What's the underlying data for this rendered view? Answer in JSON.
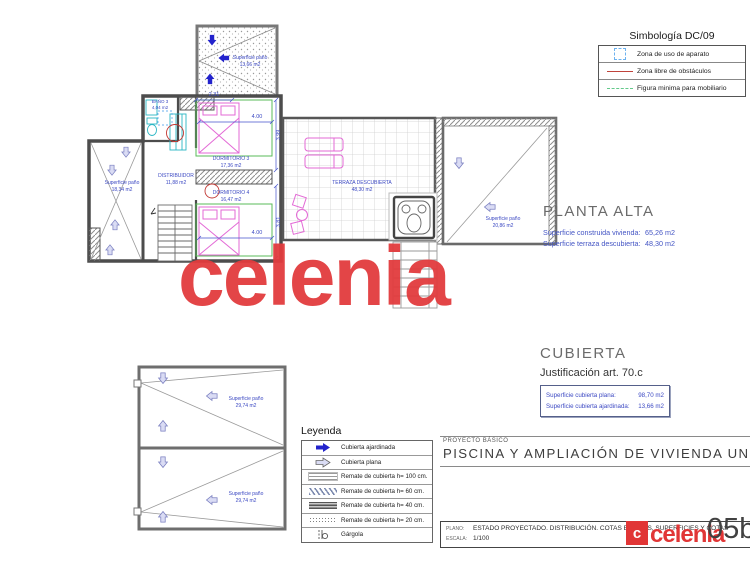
{
  "watermark": "celenia",
  "simbologia": {
    "title": "Simbología DC/09",
    "items": [
      {
        "icon": "zone-square-icon",
        "label": "Zona de uso de aparato"
      },
      {
        "icon": "red-line-icon",
        "label": "Zona libre de obstáculos"
      },
      {
        "icon": "green-line-icon",
        "label": "Figura minima para mobiliario"
      }
    ]
  },
  "planta_alta": {
    "title": "PLANTA ALTA",
    "rows": [
      {
        "label": "Superficie construida vivienda:",
        "value": "65,26 m2"
      },
      {
        "label": "Superficie terraza descubierta:",
        "value": "48,30 m2"
      }
    ]
  },
  "cubierta": {
    "title": "CUBIERTA",
    "subtitle": "Justificación art. 70.c",
    "rows": [
      {
        "label": "Superficie cubierta plana:",
        "value": "98,70 m2"
      },
      {
        "label": "Superficie cubierta ajardinada:",
        "value": "13,66 m2"
      }
    ]
  },
  "leyenda": {
    "title": "Leyenda",
    "items": [
      {
        "icon": "arrow-solid",
        "label": "Cubierta ajardinada"
      },
      {
        "icon": "arrow-outline",
        "label": "Cubierta plana"
      },
      {
        "icon": "hatch-100",
        "label": "Remate de cubierta h= 100 cm."
      },
      {
        "icon": "hatch-60",
        "label": "Remate de cubierta h= 60 cm."
      },
      {
        "icon": "hatch-40",
        "label": "Remate de cubierta h= 40 cm."
      },
      {
        "icon": "hatch-20",
        "label": "Remate de cubierta h= 20 cm."
      },
      {
        "icon": "gargoyle",
        "label": "Gárgola"
      }
    ]
  },
  "title_block": {
    "project_type": "PROYECTO BÁSICO",
    "project_title": "PISCINA Y AMPLIACIÓN  DE VIVIENDA UNIFAMILIAR",
    "plano_label": "PLANO:",
    "plano_value": "ESTADO PROYECTADO. DISTRIBUCIÓN. COTAS BÁSICAS, SUPERFICIES Y COTAS",
    "escala_label": "ESCALA:",
    "escala_value": "1/100",
    "logo_mark": "c",
    "logo_text": "celenia",
    "sheet_number": "05b"
  },
  "plan": {
    "patio_top": {
      "label": "Superficie paño",
      "area": "13,66 m2"
    },
    "patio_left": {
      "label": "Superficie paño",
      "area": "18,34 m2"
    },
    "patio_right": {
      "label": "Superficie paño",
      "area": "20,86 m2"
    },
    "bano3": {
      "label": "BAÑO 3",
      "area": "4,04 m2"
    },
    "dormitorio3": {
      "label": "DORMITORIO 3",
      "area": "17,36 m2"
    },
    "dormitorio4": {
      "label": "DORMITORIO 4",
      "area": "16,47 m2"
    },
    "distribuidor": {
      "label": "DISTRIBUIDOR",
      "area": "11,88 m2"
    },
    "terraza": {
      "label": "TERRAZA DESCUBIERTA",
      "area": "48,30 m2"
    },
    "roof_panel_1": {
      "label": "Superficie paño",
      "area": "29,74 m2"
    },
    "roof_panel_2": {
      "label": "Superficie paño",
      "area": "29,74 m2"
    },
    "dims": {
      "d1": "2.31",
      "d2": "4.00",
      "d3": "3.99",
      "d4": "4.00",
      "d5": "3.81"
    }
  }
}
